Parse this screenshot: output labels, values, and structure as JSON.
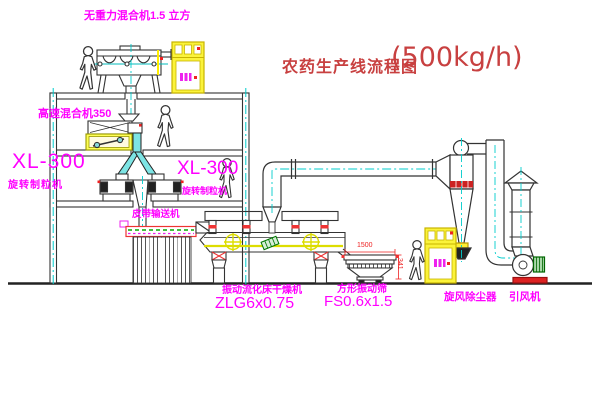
{
  "title": {
    "text": "农药生产线流程图",
    "capacity": "(500kg/h)"
  },
  "labels": {
    "gravity_mixer": "无重力混合机1.5 立方",
    "high_speed_mixer": "高速混合机350",
    "granulator_left_model": "XL-300",
    "granulator_left_name": "旋转制粒机",
    "granulator_right_model": "XL-300",
    "granulator_right_name": "旋转制粒机",
    "belt_conveyor": "皮带输送机",
    "dryer_name": "振动流化床干燥机",
    "dryer_model": "ZLG6x0.75",
    "sieve_name": "方形振动筛",
    "sieve_model": "FS0.6x1.5",
    "dust_collector": "旋风除尘器",
    "induced_fan": "引风机"
  },
  "dimensions": {
    "sieve_width": "1500",
    "sieve_side": "341"
  },
  "colors": {
    "label": "#ff00ff",
    "title": "#c84040",
    "dimension": "#ee2222",
    "line": "#333333",
    "centerline": "#00cccc",
    "highlight": "#fbf33a"
  }
}
